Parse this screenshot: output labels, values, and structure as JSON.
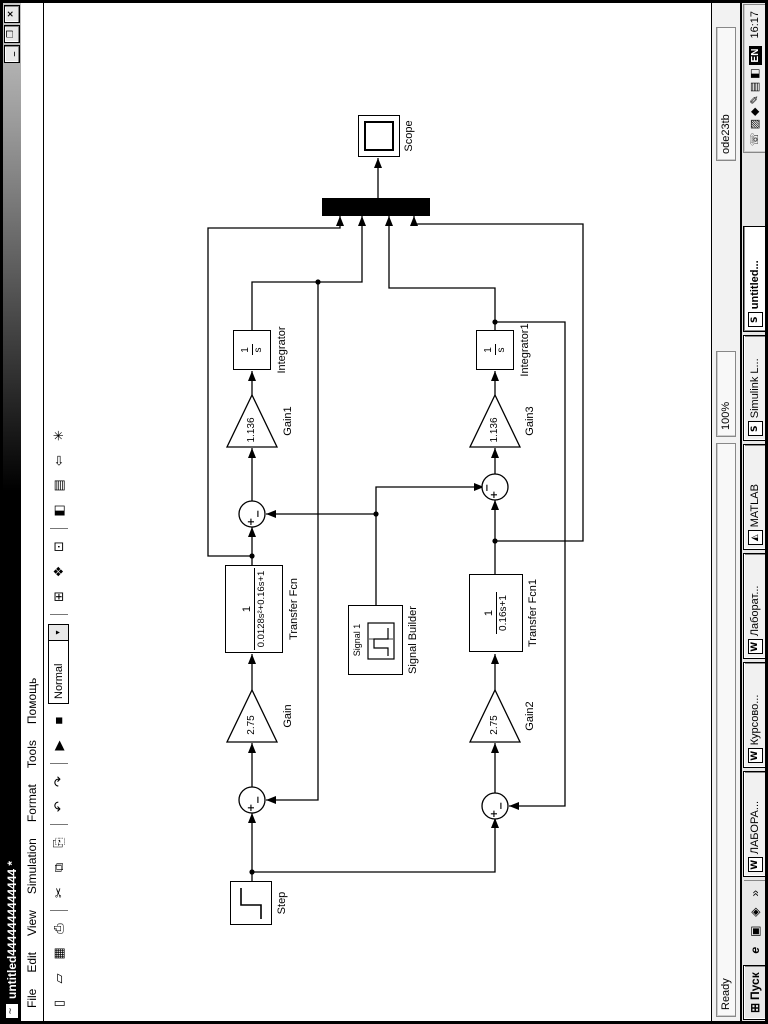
{
  "window": {
    "icon_glyph": "~",
    "title": "untitled4444444444444 *",
    "minimize": "_",
    "maximize": "❐",
    "close": "×"
  },
  "menu": {
    "items": [
      "File",
      "Edit",
      "View",
      "Simulation",
      "Format",
      "Tools",
      "Помощь"
    ]
  },
  "toolbar": {
    "mode": "Normal",
    "dropdown_arrow": "▾",
    "icons": [
      {
        "name": "new",
        "glyph": "▯"
      },
      {
        "name": "open",
        "glyph": "▱"
      },
      {
        "name": "save",
        "glyph": "▦"
      },
      {
        "name": "print",
        "glyph": "⎙"
      },
      {
        "name": "cut",
        "glyph": "✂"
      },
      {
        "name": "copy",
        "glyph": "⧉"
      },
      {
        "name": "paste",
        "glyph": "⎘"
      },
      {
        "name": "undo",
        "glyph": "↶"
      },
      {
        "name": "redo",
        "glyph": "↷"
      },
      {
        "name": "play",
        "glyph": "▶"
      },
      {
        "name": "stop",
        "glyph": "■"
      },
      {
        "name": "update-diagram",
        "glyph": "⊞"
      },
      {
        "name": "library-browser",
        "glyph": "❖"
      },
      {
        "name": "model-browser",
        "glyph": "⊡"
      },
      {
        "name": "toggle-browser",
        "glyph": "◧"
      },
      {
        "name": "workspace",
        "glyph": "▤"
      },
      {
        "name": "go-to-parent",
        "glyph": "⇦"
      },
      {
        "name": "debug",
        "glyph": "✳"
      }
    ]
  },
  "diagram": {
    "step": {
      "label": "Step"
    },
    "gain": {
      "value": "2.75",
      "label": "Gain"
    },
    "tf": {
      "num": "1",
      "den": "0.0128s²+0.16s+1",
      "label": "Transfer Fcn"
    },
    "gain1": {
      "value": "1.136",
      "label": "Gain1"
    },
    "integrator": {
      "num": "1",
      "den": "s",
      "label": "Integrator"
    },
    "scope": {
      "label": "Scope"
    },
    "signal_builder": {
      "signal": "Signal 1",
      "label": "Signal Builder"
    },
    "gain2": {
      "value": "2.75",
      "label": "Gain2"
    },
    "tf1": {
      "num": "1",
      "den": "0.16s+1",
      "label": "Transfer Fcn1"
    },
    "gain3": {
      "value": "1.136",
      "label": "Gain3"
    },
    "integrator1": {
      "num": "1",
      "den": "s",
      "label": "Integrator1"
    },
    "sum_plus": "+",
    "sum_minus": "−"
  },
  "status": {
    "ready": "Ready",
    "zoom": "100%",
    "solver": "ode23tb"
  },
  "taskbar": {
    "start": "Пуск",
    "start_icon": "⊞",
    "quick_launch": [
      "e",
      "▣",
      "◈"
    ],
    "overflow": "»",
    "windows": [
      {
        "icon": "W",
        "label": "ЛАБОРА..."
      },
      {
        "icon": "W",
        "label": "Курсово..."
      },
      {
        "icon": "W",
        "label": "Лаборат..."
      },
      {
        "icon": "◭",
        "label": "MATLAB"
      },
      {
        "icon": "S",
        "label": "Simulink L..."
      },
      {
        "icon": "S",
        "label": "untitled..."
      }
    ],
    "tray": {
      "icons": [
        "☏",
        "▨",
        "◆",
        "✎",
        "▤",
        "◧"
      ],
      "lang": "EN",
      "clock": "16:17"
    }
  }
}
